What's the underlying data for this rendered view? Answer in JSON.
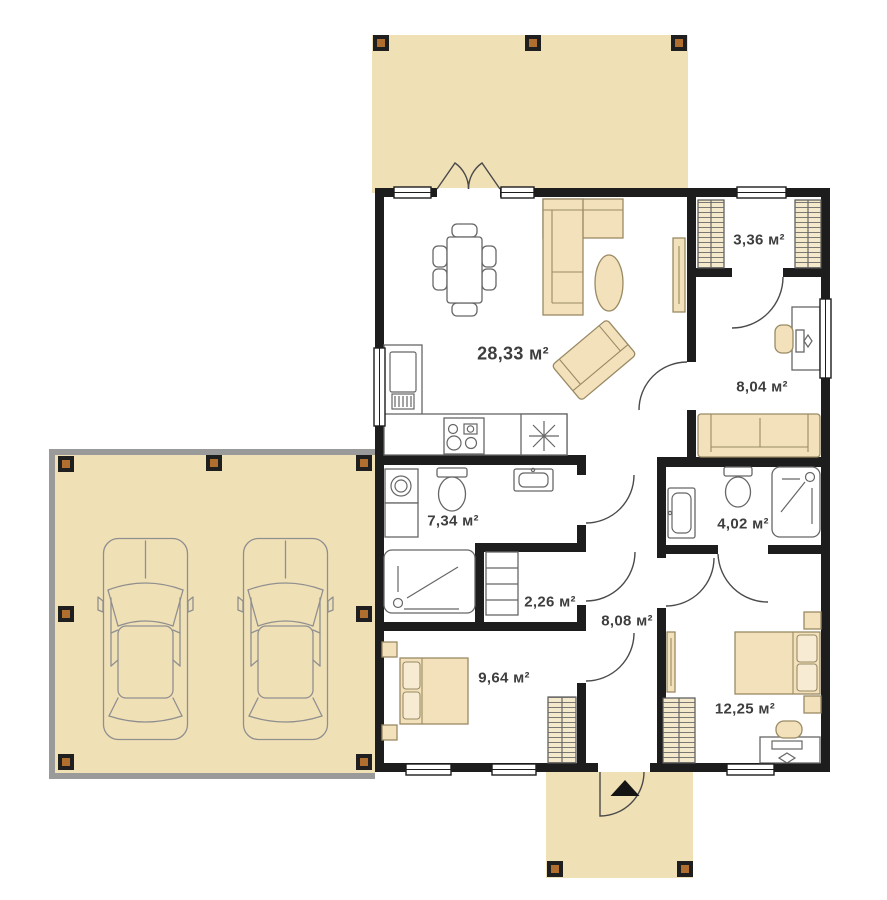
{
  "plan_title": "single-storey-house-floor-plan",
  "unit_suffix": "м²",
  "rooms": [
    {
      "name": "living-room-kitchen",
      "area_label": "28,33 м²"
    },
    {
      "name": "wardrobe-closet",
      "area_label": "3,36 м²"
    },
    {
      "name": "office-room",
      "area_label": "8,04 м²"
    },
    {
      "name": "bathroom-large",
      "area_label": "7,34 м²"
    },
    {
      "name": "bathroom-ensuite",
      "area_label": "4,02 м²"
    },
    {
      "name": "storage",
      "area_label": "2,26 м²"
    },
    {
      "name": "hallway",
      "area_label": "8,08 м²"
    },
    {
      "name": "bedroom-small",
      "area_label": "9,64 м²"
    },
    {
      "name": "bedroom-large",
      "area_label": "12,25 м²"
    }
  ],
  "outdoor_areas": [
    "terrace",
    "carport",
    "entrance-porch"
  ],
  "icons": [
    "car-icon",
    "dining-table-icon",
    "corner-sofa-icon",
    "coffee-table-icon",
    "lounge-chair-icon",
    "tv-unit-icon",
    "fridge-icon",
    "cooktop-icon",
    "sink-icon",
    "washing-machine-icon",
    "toilet-icon",
    "shower-icon",
    "shelves-icon",
    "wardrobe-icon",
    "double-bed-icon",
    "desk-icon",
    "office-chair-icon",
    "mirror-icon",
    "entrance-arrow-icon",
    "door-swing-icon",
    "window-icon",
    "post-icon"
  ],
  "colors": {
    "deck": "#f0e0b6",
    "wall": "#1d1d1d",
    "furniture": "#f2e1ba",
    "furniture_outline": "#9a8a64",
    "fixture_outline": "#666666",
    "post": "#b06f2e",
    "post_border": "#1f1f1f",
    "carport_border": "#9a9a9a",
    "car_outline": "#8f8f8f",
    "label_text": "#3e3e3e"
  }
}
